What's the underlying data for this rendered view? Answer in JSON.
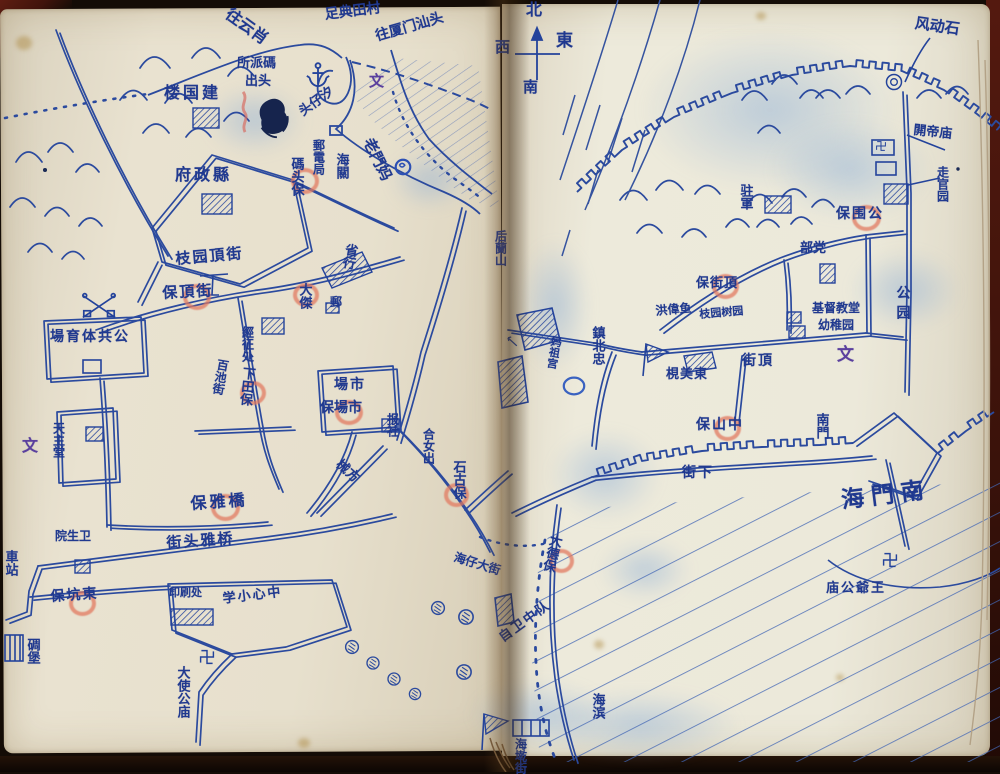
{
  "palette": {
    "ink": "#2b4a9e",
    "ink_dark": "#20398f",
    "red_mark": "#e27a60",
    "purple_mark": "#5b3f9e",
    "paper_left": "#e9e2d0",
    "paper_right": "#ece9da",
    "cover": "#54190f",
    "smudge_blue": "#7da5d7"
  },
  "compass": {
    "north": "北",
    "south": "南",
    "east": "東",
    "west": "西"
  },
  "labels": [
    {
      "name": "route-yunxiao",
      "text": "往云肖",
      "x": 232,
      "y": 6,
      "dir": "d",
      "rot": 36,
      "size": 16
    },
    {
      "name": "route-diantian-village",
      "text": "足典田村",
      "x": 324,
      "y": 8,
      "dir": "d",
      "rot": -7,
      "size": 14
    },
    {
      "name": "route-xiamen-shantou",
      "text": "往厦门汕头",
      "x": 374,
      "y": 30,
      "dir": "d",
      "rot": -16,
      "size": 14
    },
    {
      "name": "xizaitou-pier",
      "text": "头仔汐",
      "x": 297,
      "y": 108,
      "dir": "d",
      "rot": -36,
      "size": 13
    },
    {
      "name": "wen-mark-harbor",
      "text": "文",
      "x": 369,
      "y": 74,
      "dir": "h",
      "size": 15,
      "color": "purple"
    },
    {
      "name": "matou-police-line1",
      "text": "所派碼",
      "x": 237,
      "y": 57,
      "dir": "h",
      "size": 13
    },
    {
      "name": "matou-police-line2",
      "text": "出头",
      "x": 245,
      "y": 75,
      "dir": "h",
      "size": 13
    },
    {
      "name": "jianguo-building",
      "text": "楼国建",
      "x": 164,
      "y": 85,
      "dir": "h",
      "size": 16,
      "spacing": 3
    },
    {
      "name": "county-government",
      "text": "府政縣",
      "x": 175,
      "y": 167,
      "dir": "h",
      "size": 16,
      "spacing": 3
    },
    {
      "name": "laomen-ma",
      "text": "老門妈",
      "x": 374,
      "y": 136,
      "dir": "d",
      "rot": 64,
      "size": 15
    },
    {
      "name": "post-telegraph-office",
      "text": "郵電局",
      "x": 312,
      "y": 139,
      "dir": "v",
      "size": 12
    },
    {
      "name": "matou-bao",
      "text": "碼头保",
      "x": 289,
      "y": 157,
      "dir": "v",
      "size": 13
    },
    {
      "name": "customs-house",
      "text": "海關",
      "x": 334,
      "y": 153,
      "dir": "v",
      "size": 13
    },
    {
      "name": "provincial-bank",
      "text": "省行",
      "x": 344,
      "y": 242,
      "dir": "v",
      "rot": 10,
      "size": 13
    },
    {
      "name": "post-box-label",
      "text": "郵",
      "x": 330,
      "y": 296,
      "dir": "h",
      "size": 12
    },
    {
      "name": "dajie-label",
      "text": "大傑",
      "x": 297,
      "y": 283,
      "dir": "v",
      "size": 13
    },
    {
      "name": "tax-collection-office",
      "text": "經征处",
      "x": 241,
      "y": 326,
      "dir": "v",
      "size": 12
    },
    {
      "name": "zhiyuan-top-street",
      "text": "枝园頂街",
      "x": 175,
      "y": 252,
      "dir": "d",
      "rot": -5,
      "size": 15,
      "spacing": 2
    },
    {
      "name": "dingjie-bao-west",
      "text": "保頂街",
      "x": 162,
      "y": 286,
      "dir": "d",
      "rot": -3,
      "size": 15,
      "spacing": 2
    },
    {
      "name": "public-stadium",
      "text": "場育体共公",
      "x": 50,
      "y": 330,
      "dir": "h",
      "size": 14,
      "spacing": 2
    },
    {
      "name": "wen-mark-west",
      "text": "文",
      "x": 22,
      "y": 438,
      "dir": "h",
      "size": 16,
      "color": "purple"
    },
    {
      "name": "catholic-church",
      "text": "天主堂",
      "x": 52,
      "y": 422,
      "dir": "v",
      "size": 12
    },
    {
      "name": "baichi-street",
      "text": "百池街",
      "x": 217,
      "y": 358,
      "dir": "v",
      "rot": 10,
      "size": 12
    },
    {
      "name": "xiatian-bao",
      "text": "下田保",
      "x": 241,
      "y": 366,
      "dir": "v",
      "rot": 6,
      "size": 13
    },
    {
      "name": "market",
      "text": "場市",
      "x": 334,
      "y": 378,
      "dir": "h",
      "size": 14,
      "spacing": 2
    },
    {
      "name": "shichang-bao",
      "text": "保場市",
      "x": 320,
      "y": 401,
      "dir": "h",
      "size": 14
    },
    {
      "name": "newspaper-office",
      "text": "报社",
      "x": 386,
      "y": 413,
      "dir": "v",
      "size": 12
    },
    {
      "name": "xiefang-street",
      "text": "械方",
      "x": 342,
      "y": 458,
      "dir": "d",
      "rot": 42,
      "size": 13
    },
    {
      "name": "henuchu-label",
      "text": "合女出",
      "x": 422,
      "y": 428,
      "dir": "v",
      "size": 12
    },
    {
      "name": "shigu-bao",
      "text": "石古保",
      "x": 451,
      "y": 460,
      "dir": "v",
      "size": 13
    },
    {
      "name": "qiaoya-bao",
      "text": "保雅橋",
      "x": 190,
      "y": 496,
      "dir": "d",
      "rot": -4,
      "size": 16,
      "spacing": 3
    },
    {
      "name": "qiaoyatou-street",
      "text": "街头雅桥",
      "x": 166,
      "y": 536,
      "dir": "d",
      "rot": -4,
      "size": 15,
      "spacing": 2
    },
    {
      "name": "health-clinic",
      "text": "院生卫",
      "x": 55,
      "y": 530,
      "dir": "h",
      "size": 12
    },
    {
      "name": "bus-station",
      "text": "車站",
      "x": 3,
      "y": 550,
      "dir": "v",
      "size": 13
    },
    {
      "name": "dongkeng-bao",
      "text": "保坑東",
      "x": 50,
      "y": 590,
      "dir": "d",
      "rot": -4,
      "size": 14,
      "spacing": 2
    },
    {
      "name": "pillbox",
      "text": "碉堡",
      "x": 25,
      "y": 638,
      "dir": "v",
      "size": 13
    },
    {
      "name": "printing-office",
      "text": "印刷处",
      "x": 169,
      "y": 587,
      "dir": "h",
      "size": 11
    },
    {
      "name": "central-primary-school",
      "text": "学小心中",
      "x": 222,
      "y": 593,
      "dir": "d",
      "rot": -7,
      "size": 13,
      "spacing": 2
    },
    {
      "name": "dashigong-temple",
      "text": "大使公庙",
      "x": 175,
      "y": 666,
      "dir": "v",
      "size": 13
    },
    {
      "name": "haizai-main-street",
      "text": "海仔大街",
      "x": 456,
      "y": 551,
      "dir": "d",
      "rot": 17,
      "size": 12
    },
    {
      "name": "dade-bao",
      "text": "大德保",
      "x": 549,
      "y": 532,
      "dir": "v",
      "rot": 14,
      "size": 13
    },
    {
      "name": "self-defense-squad",
      "text": "自卫中队",
      "x": 497,
      "y": 634,
      "dir": "d",
      "rot": -36,
      "size": 13,
      "spacing": 2
    },
    {
      "name": "haibin-label",
      "text": "海滨",
      "x": 590,
      "y": 693,
      "dir": "v",
      "size": 13
    },
    {
      "name": "haiqian-street",
      "text": "海墘街",
      "x": 514,
      "y": 738,
      "dir": "v",
      "size": 12
    },
    {
      "name": "fengdong-rock",
      "text": "风动石",
      "x": 916,
      "y": 16,
      "dir": "d",
      "rot": 8,
      "size": 15
    },
    {
      "name": "guandi-temple",
      "text": "閞帝庙",
      "x": 914,
      "y": 124,
      "dir": "d",
      "rot": 6,
      "size": 13
    },
    {
      "name": "zouguanyuan-label",
      "text": "走官园",
      "x": 936,
      "y": 166,
      "dir": "v",
      "size": 12
    },
    {
      "name": "garrison",
      "text": "驻軍",
      "x": 738,
      "y": 184,
      "dir": "v",
      "size": 13
    },
    {
      "name": "gongyuan-bao",
      "text": "保围公",
      "x": 836,
      "y": 207,
      "dir": "h",
      "size": 14,
      "spacing": 2
    },
    {
      "name": "party-headquarters",
      "text": "部党",
      "x": 800,
      "y": 242,
      "dir": "h",
      "size": 13
    },
    {
      "name": "dingjie-bao-east",
      "text": "保街頂",
      "x": 696,
      "y": 277,
      "dir": "h",
      "size": 13,
      "spacing": 1
    },
    {
      "name": "hongweiyu-label",
      "text": "洪偉鱼",
      "x": 655,
      "y": 305,
      "dir": "d",
      "rot": -5,
      "size": 12
    },
    {
      "name": "orchard-label",
      "text": "枝园树园",
      "x": 699,
      "y": 309,
      "dir": "d",
      "rot": -5,
      "size": 11
    },
    {
      "name": "christian-church",
      "text": "基督教堂",
      "x": 812,
      "y": 302,
      "dir": "h",
      "size": 12
    },
    {
      "name": "kindergarten",
      "text": "幼稚园",
      "x": 818,
      "y": 319,
      "dir": "h",
      "size": 12
    },
    {
      "name": "park-label",
      "text": "公园",
      "x": 895,
      "y": 285,
      "dir": "v",
      "size": 14,
      "spacing": 6
    },
    {
      "name": "wen-mark-east",
      "text": "文",
      "x": 837,
      "y": 347,
      "dir": "h",
      "size": 17,
      "color": "purple"
    },
    {
      "name": "zhenbei-gate",
      "text": "鎮北忠",
      "x": 590,
      "y": 326,
      "dir": "v",
      "size": 13
    },
    {
      "name": "mazu-temple",
      "text": "妈祖宫",
      "x": 551,
      "y": 335,
      "dir": "v",
      "rot": 10,
      "size": 11
    },
    {
      "name": "dongmei-label",
      "text": "梘美東",
      "x": 666,
      "y": 368,
      "dir": "h",
      "size": 13,
      "spacing": 1
    },
    {
      "name": "top-street",
      "text": "街頂",
      "x": 742,
      "y": 354,
      "dir": "h",
      "size": 14,
      "spacing": 2
    },
    {
      "name": "zhongshan-bao",
      "text": "保山中",
      "x": 696,
      "y": 418,
      "dir": "h",
      "size": 14,
      "spacing": 2
    },
    {
      "name": "south-gate",
      "text": "南門",
      "x": 814,
      "y": 413,
      "dir": "v",
      "size": 13
    },
    {
      "name": "lower-street",
      "text": "街下",
      "x": 682,
      "y": 466,
      "dir": "h",
      "size": 14,
      "spacing": 2
    },
    {
      "name": "nanmen-sea",
      "text": "海門南",
      "x": 840,
      "y": 490,
      "dir": "d",
      "rot": -7,
      "size": 23,
      "spacing": 7
    },
    {
      "name": "wangyegong-temple",
      "text": "庙公爺王",
      "x": 826,
      "y": 582,
      "dir": "h",
      "size": 13,
      "spacing": 2
    },
    {
      "name": "houlan-hill",
      "text": "后蘭山",
      "x": 494,
      "y": 230,
      "dir": "v",
      "size": 12
    }
  ],
  "red_circles": [
    {
      "x": 291,
      "y": 168,
      "w": 20,
      "h": 18,
      "label": "碼头保"
    },
    {
      "x": 293,
      "y": 283,
      "w": 18,
      "h": 16,
      "label": "大傑"
    },
    {
      "x": 183,
      "y": 284,
      "w": 20,
      "h": 18,
      "label": "保頂街"
    },
    {
      "x": 240,
      "y": 381,
      "w": 18,
      "h": 16,
      "label": "下田保"
    },
    {
      "x": 335,
      "y": 400,
      "w": 20,
      "h": 17,
      "label": "保場市"
    },
    {
      "x": 444,
      "y": 483,
      "w": 17,
      "h": 16,
      "label": "石古保"
    },
    {
      "x": 211,
      "y": 494,
      "w": 21,
      "h": 19,
      "label": "保雅橋"
    },
    {
      "x": 69,
      "y": 591,
      "w": 19,
      "h": 17,
      "label": "保坑東"
    },
    {
      "x": 852,
      "y": 205,
      "w": 21,
      "h": 18,
      "label": "保围公"
    },
    {
      "x": 712,
      "y": 274,
      "w": 19,
      "h": 17,
      "label": "保街頂"
    },
    {
      "x": 714,
      "y": 416,
      "w": 19,
      "h": 17,
      "label": "保山中"
    },
    {
      "x": 549,
      "y": 549,
      "w": 17,
      "h": 16,
      "label": "大德保"
    }
  ],
  "icons": [
    {
      "type": "anchor-icon",
      "x": 318,
      "y": 74,
      "size": 26
    },
    {
      "type": "swastika-icon",
      "x": 207,
      "y": 657,
      "size": 16
    },
    {
      "type": "swastika-icon",
      "x": 890,
      "y": 560,
      "size": 16
    },
    {
      "type": "swastika-icon",
      "x": 881,
      "y": 146,
      "size": 11
    },
    {
      "type": "blue-circle-icon",
      "x": 403,
      "y": 167,
      "size": 20
    },
    {
      "type": "blue-oval-icon",
      "x": 574,
      "y": 386,
      "size": 26
    },
    {
      "type": "crossed-poles-icon",
      "x": 99,
      "y": 306,
      "size": 38
    },
    {
      "type": "ink-blot-icon",
      "x": 275,
      "y": 118,
      "size": 48
    },
    {
      "type": "red-scribble-icon",
      "x": 245,
      "y": 112,
      "size": 44
    },
    {
      "type": "tree-icon",
      "x": 352,
      "y": 647,
      "size": 17
    },
    {
      "type": "tree-icon",
      "x": 373,
      "y": 663,
      "size": 16
    },
    {
      "type": "tree-icon",
      "x": 394,
      "y": 679,
      "size": 16
    },
    {
      "type": "tree-icon",
      "x": 415,
      "y": 694,
      "size": 15
    },
    {
      "type": "tree-icon",
      "x": 438,
      "y": 608,
      "size": 17
    },
    {
      "type": "tree-icon",
      "x": 466,
      "y": 617,
      "size": 19
    },
    {
      "type": "tree-icon",
      "x": 464,
      "y": 672,
      "size": 19
    },
    {
      "type": "rock-icon",
      "x": 894,
      "y": 82,
      "size": 20
    },
    {
      "type": "dot-icon",
      "x": 45,
      "y": 170,
      "size": 6
    },
    {
      "type": "dot-icon",
      "x": 958,
      "y": 169,
      "size": 5
    },
    {
      "type": "arrow-icon",
      "x": 512,
      "y": 341,
      "size": 16
    }
  ]
}
